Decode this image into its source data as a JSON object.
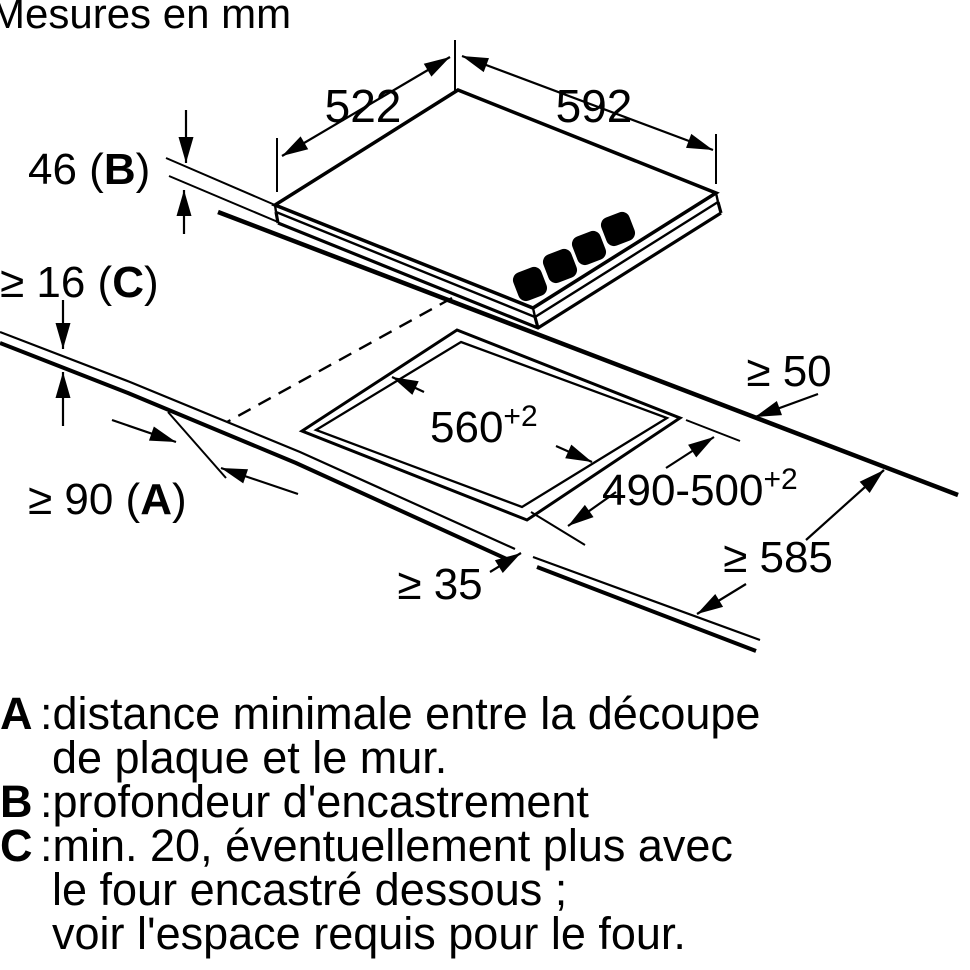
{
  "title": "Mesures en mm",
  "diagram": {
    "dim_top_width": "522",
    "dim_top_depth": "592",
    "dim_hob_height": {
      "prefix": "46 (",
      "letter": "B",
      "suffix": ")"
    },
    "dim_worktop_thickness": {
      "prefix": "≥ 16 (",
      "letter": "C",
      "suffix": ")"
    },
    "dim_wall_clearance": {
      "prefix": "≥ 90 (",
      "letter": "A",
      "suffix": ")"
    },
    "dim_cutout_width": {
      "base": "560",
      "sup": "+2"
    },
    "dim_cutout_depth": {
      "base": "490-500",
      "sup": "+2"
    },
    "dim_back_clearance": "≥ 50",
    "dim_worktop_depth": "≥ 585",
    "dim_front_clearance": "≥ 35"
  },
  "legend": {
    "a": {
      "letter": "A",
      "sep": ":",
      "line1": "distance minimale entre la découpe",
      "line2": "de plaque et le mur."
    },
    "b": {
      "letter": "B",
      "sep": ":",
      "line1": "profondeur d'encastrement"
    },
    "c": {
      "letter": "C",
      "sep": ":",
      "line1": "min. 20, éventuellement plus avec",
      "line2": "le four encastré dessous ;",
      "line3": "voir l'espace requis pour le four."
    }
  },
  "colors": {
    "line": "#000000",
    "background": "#ffffff"
  }
}
